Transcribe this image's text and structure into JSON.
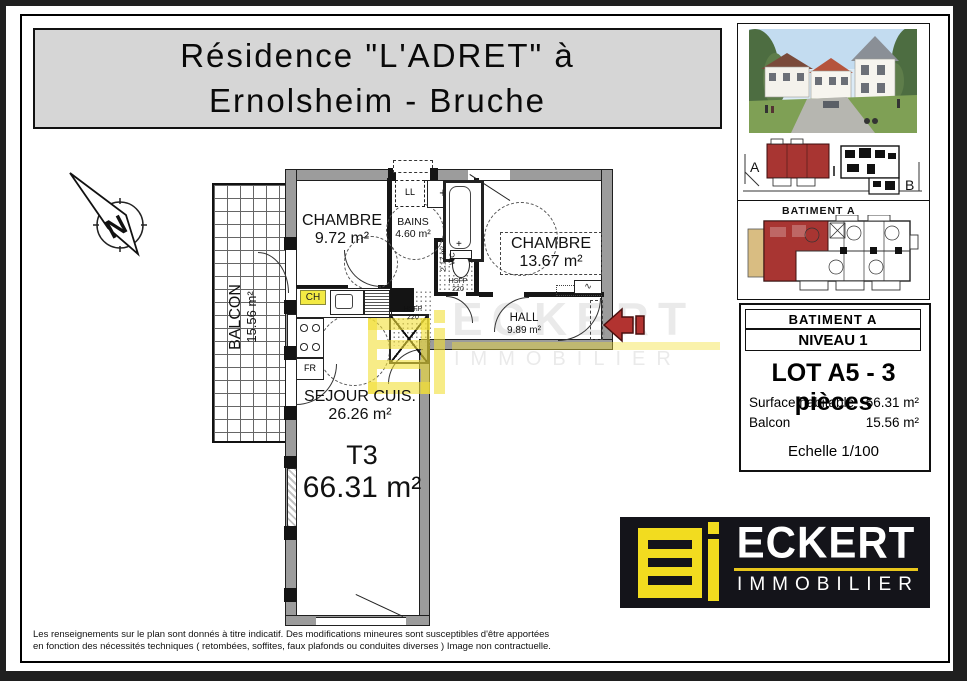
{
  "header": {
    "title_line1": "Résidence  \"L'ADRET\"  à",
    "title_line2": "Ernolsheim - Bruche"
  },
  "compass": {
    "label": "N"
  },
  "plan": {
    "balcony": {
      "name": "BALCON",
      "area": "15.56 m²"
    },
    "chambre1": {
      "name": "CHAMBRE",
      "area": "9.72 m²"
    },
    "bains": {
      "name": "BAINS",
      "area": "4.60 m²"
    },
    "chambre2": {
      "name": "CHAMBRE",
      "area": "13.67 m²"
    },
    "wc": {
      "area": "2.17 m²",
      "name": "WC"
    },
    "hall": {
      "name": "HALL",
      "area": "9.89 m²"
    },
    "sejour": {
      "name": "SEJOUR CUIS.",
      "area": "26.26 m²"
    },
    "lot_type": "T3",
    "lot_area": "66.31 m²",
    "tags": {
      "ll": "LL",
      "ch": "CH",
      "fr": "FR",
      "hsfp_line1": "HSFP",
      "hsfp_line2": "220"
    }
  },
  "watermark": {
    "line1": "ECKERT",
    "line2": "IMMOBILIER"
  },
  "site_plan": {
    "label_a": "A",
    "label_b": "B"
  },
  "batiment_panel": {
    "title": "BATIMENT A"
  },
  "info_panel": {
    "batiment": "BATIMENT A",
    "niveau": "NIVEAU 1",
    "lot": "LOT A5 - 3 pièces",
    "surface_label": "Surface habitable",
    "surface_value": "66.31 m²",
    "balcon_label": "Balcon",
    "balcon_value": "15.56 m²",
    "echelle": "Echelle 1/100"
  },
  "logo": {
    "brand": "ECKERT",
    "sub": "IMMOBILIER"
  },
  "footer": {
    "line1": "Les renseignements sur le plan sont donnés à titre indicatif. Des modifications mineures sont susceptibles d'être apportées",
    "line2": "en fonction des nécessités techniques ( retombées, soffites, faux plafonds ou conduites diverses )   Image non contractuelle."
  },
  "colors": {
    "accent_yellow": "#f2dc1f",
    "brand_red": "#a83532",
    "wall_grey": "#9c9c9c",
    "panel_grey": "#d6d6d6",
    "balcony_tan": "#d9bd82"
  }
}
